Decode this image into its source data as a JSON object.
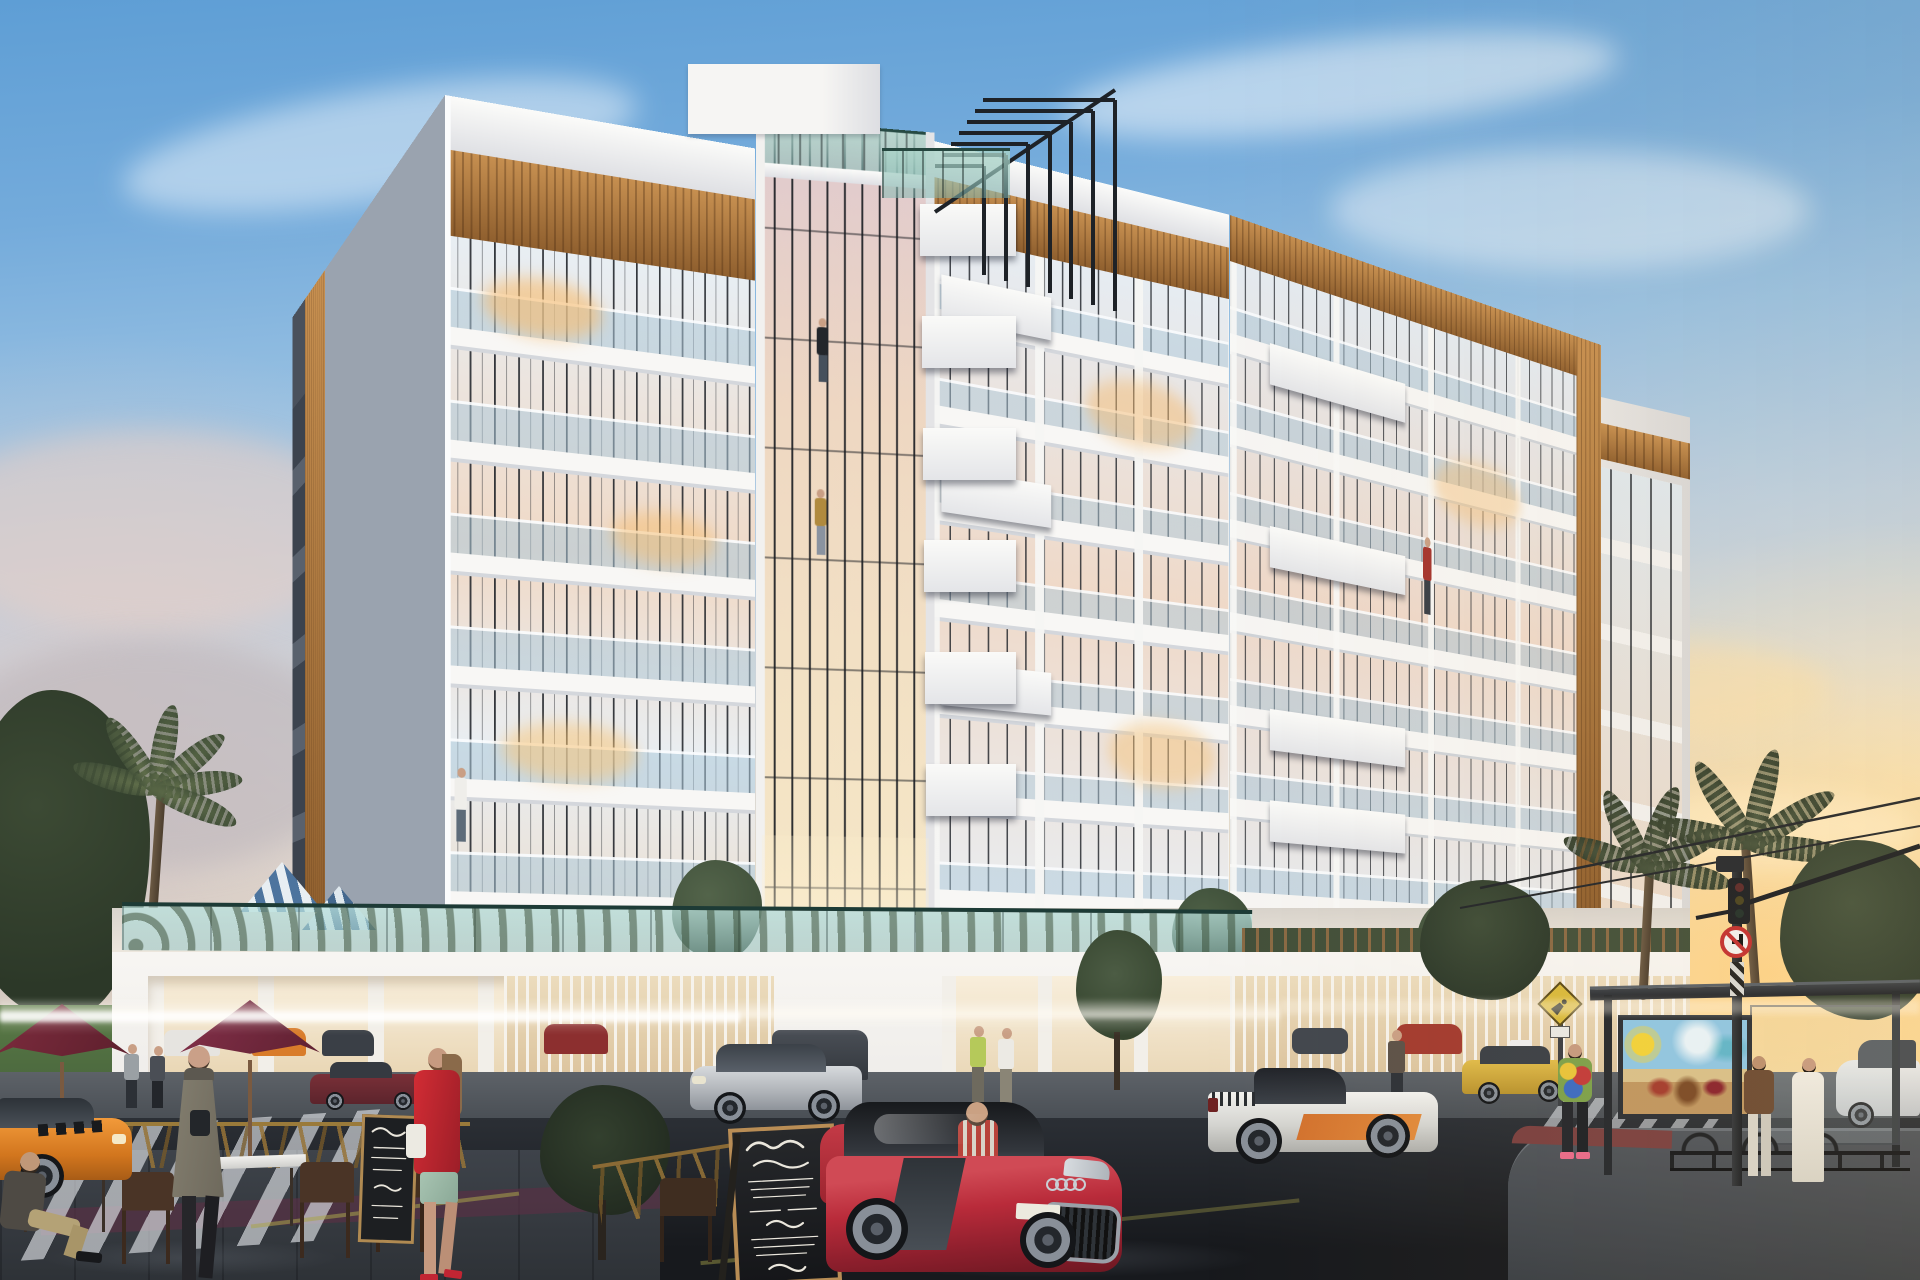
{
  "scene": {
    "title": "Photorealistic dusk rendering of a modern white mid-rise apartment building with timber accents, glass balconies, street-level café, sports cars and bus stop",
    "time_of_day": "sunset",
    "type": "architectural exterior visualization"
  },
  "palette": {
    "sky_top": "#5e9ed5",
    "sky_mid": "#bccfe0",
    "sunset_glow": "#f6d28f",
    "cloud_pink": "#e2cdc6",
    "facade_white": "#f4f3f1",
    "timber": "#b07a3f",
    "glass_cool": "#cfe0ea",
    "glass_warm": "#f2dfc4",
    "pergola_steel": "#1e2227",
    "podium_glass": "#bfe0dd",
    "asphalt": "#23262b",
    "sidewalk": "#565b61",
    "umbrella_maroon": "#6e2636",
    "pool_umbrella_blue": "#4d749e",
    "audi_red": "#b92b3a",
    "lambo_white": "#e9e8e4",
    "lambo_orange": "#d2722e",
    "taxi_orange": "#e8892c",
    "cab_yellow": "#d8b23e",
    "bmw_silver": "#c9ccd0",
    "lawn_green": "#55754a"
  },
  "building": {
    "left_wing": {
      "floors": 7,
      "features": [
        "glass balcony balustrades",
        "white balcony slabs",
        "timber fascia band",
        "timber corner column"
      ]
    },
    "center_tower": {
      "floors": 8,
      "features": [
        "double-height entrance glazing",
        "black steel roof pergola frames",
        "roof terrace glass railing",
        "stacked white box balconies"
      ]
    },
    "right_wing": {
      "floors": 7,
      "features": [
        "timber fascia band",
        "protruding white box balconies",
        "corner glass balconies"
      ]
    },
    "podium": {
      "features": [
        "teal glass parapet",
        "warm-lit open parking garage",
        "vertical slat screens",
        "roof terrace planters",
        "two blue-striped pool umbrellas"
      ]
    }
  },
  "balcony_people": {
    "count": 4,
    "positions": [
      "center tower upper balcony",
      "center tower mid balcony",
      "left wing lower balcony",
      "right wing mid balcony"
    ]
  },
  "vehicles": [
    {
      "name": "red-sports-car",
      "model_cue": "Audi R8 with four-ring grille badge and blank white plate",
      "color": "#b92b3a",
      "zone": "foreground center"
    },
    {
      "name": "silver-crossover",
      "model_cue": "BMW X6 style",
      "color": "#c9ccd0",
      "zone": "mid street center-left"
    },
    {
      "name": "white-supercar",
      "model_cue": "Lamborghini Gallardo with orange side blade",
      "color": "#e9e8e4",
      "zone": "foreground right"
    },
    {
      "name": "orange-taxi",
      "color": "#e8892c",
      "zone": "far left edge"
    },
    {
      "name": "yellow-cab",
      "color": "#d8b23e",
      "zone": "right background"
    },
    {
      "name": "maroon-sedan",
      "color": "#6e2a33",
      "zone": "left background road"
    },
    {
      "name": "white-car",
      "color": "#e8e8e6",
      "zone": "far right edge"
    },
    {
      "name": "garage-cars",
      "colors": [
        "#e6e4e0",
        "#d97c2a",
        "#3a3f46",
        "#8c2f2f"
      ],
      "zone": "inside podium garage"
    }
  ],
  "people": [
    {
      "name": "woman-grey-coat",
      "detail": "long olive-grey coat, camera strap, black boots",
      "zone": "foreground left"
    },
    {
      "name": "woman-red-coat",
      "detail": "red hooded coat, white handbag, floral skirt, red heels",
      "zone": "foreground center-left"
    },
    {
      "name": "seated-cafe-man",
      "detail": "khaki trousers, black shoes",
      "zone": "far left table"
    },
    {
      "name": "two-background-walkers",
      "zone": "left walkway"
    },
    {
      "name": "couple-at-entrance",
      "zone": "center walkway"
    },
    {
      "name": "man-by-slats",
      "zone": "right walkway"
    },
    {
      "name": "girl-tie-dye-hoodie",
      "detail": "pink shoes, looking at phone",
      "zone": "bus stop"
    },
    {
      "name": "bus-stop-group",
      "detail": "woman in brown jacket with white pants, woman in long white dress",
      "zone": "far right"
    }
  ],
  "street_furniture": {
    "cafe": {
      "maroon_umbrellas": 2,
      "white_tables": 3,
      "dark_wood_chairs": 6,
      "gold_barriers": true
    },
    "menu_boards": 2,
    "bus_shelter": {
      "billboard": "colorful beach mural with yellow sun, blue sky and figures on sand"
    },
    "traffic_signal": {
      "heads": 1,
      "camera": true,
      "mast_arm": true,
      "cables": 2
    }
  },
  "chalkboard_menu": {
    "legibility": "stylized white handwritten script, mostly illegible",
    "lines_best_effort": [
      "ashby goyan",
      "fantaisie",
      "entrée",
      "dessert"
    ],
    "description": "A-frame chalkboard menu with white cursive script"
  },
  "signs": [
    {
      "name": "pedestrian-crossing-diamond",
      "color": "#d9b93c"
    },
    {
      "name": "no-right-turn-circle",
      "colors": [
        "#ffffff",
        "#c23030",
        "#000000"
      ]
    }
  ],
  "license_plate": "blank",
  "vegetation": {
    "palms_left": 3,
    "palms_right": 2,
    "terrace_trees": 4,
    "street_tree_dark": 1,
    "lawn": "left edge"
  }
}
